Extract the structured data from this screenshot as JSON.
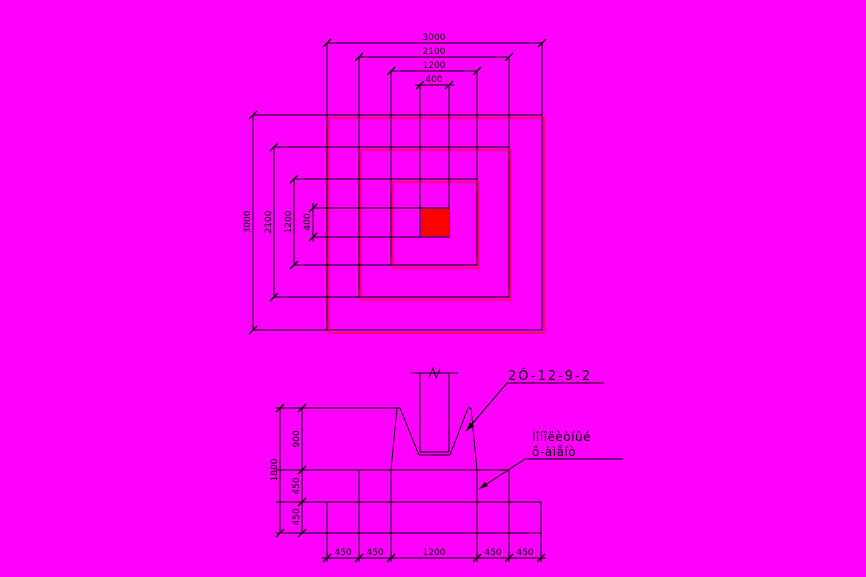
{
  "drawing": {
    "background_color": "#FF00FF",
    "line_color": "#000000",
    "highlight_color": "#FF0000",
    "plan": {
      "top_dims": [
        "3000",
        "2100",
        "1200",
        "400"
      ],
      "left_dims": [
        "3000",
        "2100",
        "1200",
        "400"
      ]
    },
    "section": {
      "left_overall_dim": "1800",
      "left_dims": [
        "900",
        "450",
        "450"
      ],
      "bottom_dims": [
        "450",
        "450",
        "1200",
        "450",
        "450"
      ],
      "rebar_mark": "2Ô-12-9-2",
      "note_line1": "Ìîíîëèòíûé",
      "note_line2": "ô-àìåíò"
    }
  }
}
